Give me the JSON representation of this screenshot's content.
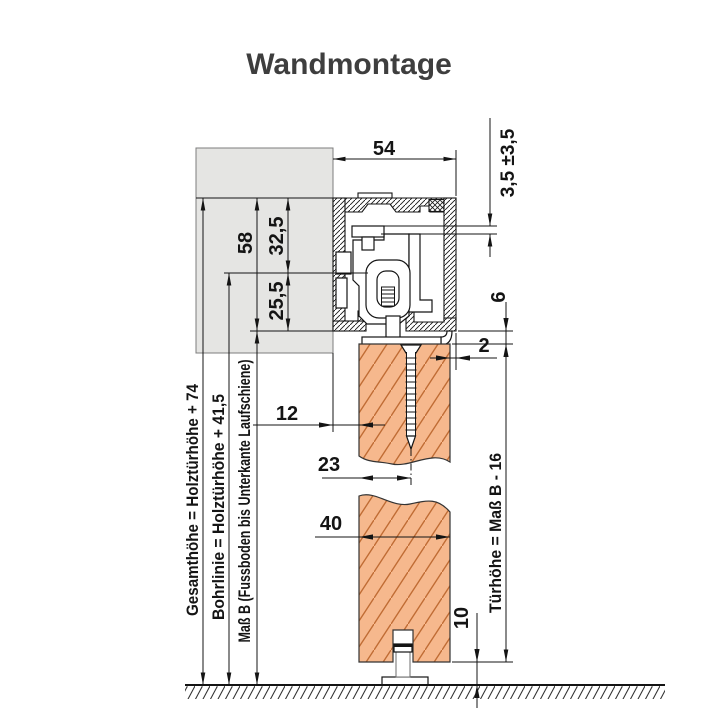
{
  "title": "Wandmontage",
  "drawing": {
    "dimensions": {
      "track_width": "54",
      "height_adjustment": "3,5 ±3,5",
      "rail_height": "58",
      "rail_top_to_drill_line": "32,5",
      "drill_line_to_rail_bottom": "25,5",
      "rail_bottom_to_door_gap": "6",
      "door_to_rail_edge": "2",
      "wall_to_door_gap": "12",
      "door_face_to_screw_axis": "23",
      "door_thickness": "40",
      "floor_clearance": "10"
    },
    "formulas": {
      "gesamthoehe": "Gesamthöhe = Holztürhöhe + 74",
      "bohrlinie": "Bohrlinie = Holztürhöhe + 41,5",
      "mass_b": "Maß B (Fussboden bis Unterkante Laufschiene)",
      "tuerhoehe": "Türhöhe = Maß B - 16"
    },
    "colors": {
      "title_color": "#3e3e3e",
      "wall_fill": "#e5e5e3",
      "door_fill": "#f6b88d",
      "door_hatch": "#c06c34",
      "line": "#141414"
    }
  }
}
